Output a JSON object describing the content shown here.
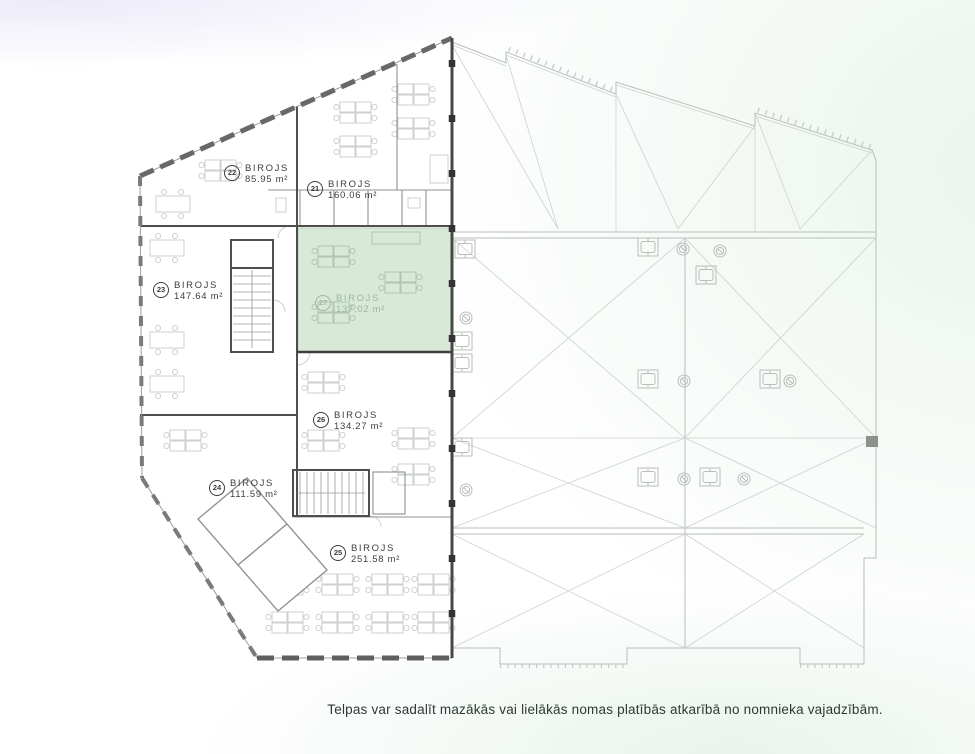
{
  "page": {
    "caption": "Telpas var sadalīt mazākās vai lielākās nomas platībās atkarībā no nomnieka vajadzībām.",
    "background": {
      "lavender": "#ecebf8",
      "mint": "#ebf4ed",
      "base": "#ffffff"
    }
  },
  "floorplan": {
    "highlight_fill": "#d8e9d8",
    "rooms": [
      {
        "number": "22",
        "name": "BIROJS",
        "area": "85.95 m²",
        "highlighted": false
      },
      {
        "number": "21",
        "name": "BIROJS",
        "area": "160.06 m²",
        "highlighted": false
      },
      {
        "number": "23",
        "name": "BIROJS",
        "area": "147.64 m²",
        "highlighted": false
      },
      {
        "number": "27",
        "name": "BIROJS",
        "area": "137.02 m²",
        "highlighted": true
      },
      {
        "number": "26",
        "name": "BIROJS",
        "area": "134.27 m²",
        "highlighted": false
      },
      {
        "number": "24",
        "name": "BIROJS",
        "area": "111.59 m²",
        "highlighted": false
      },
      {
        "number": "25",
        "name": "BIROJS",
        "area": "251.58 m²",
        "highlighted": false
      }
    ]
  }
}
